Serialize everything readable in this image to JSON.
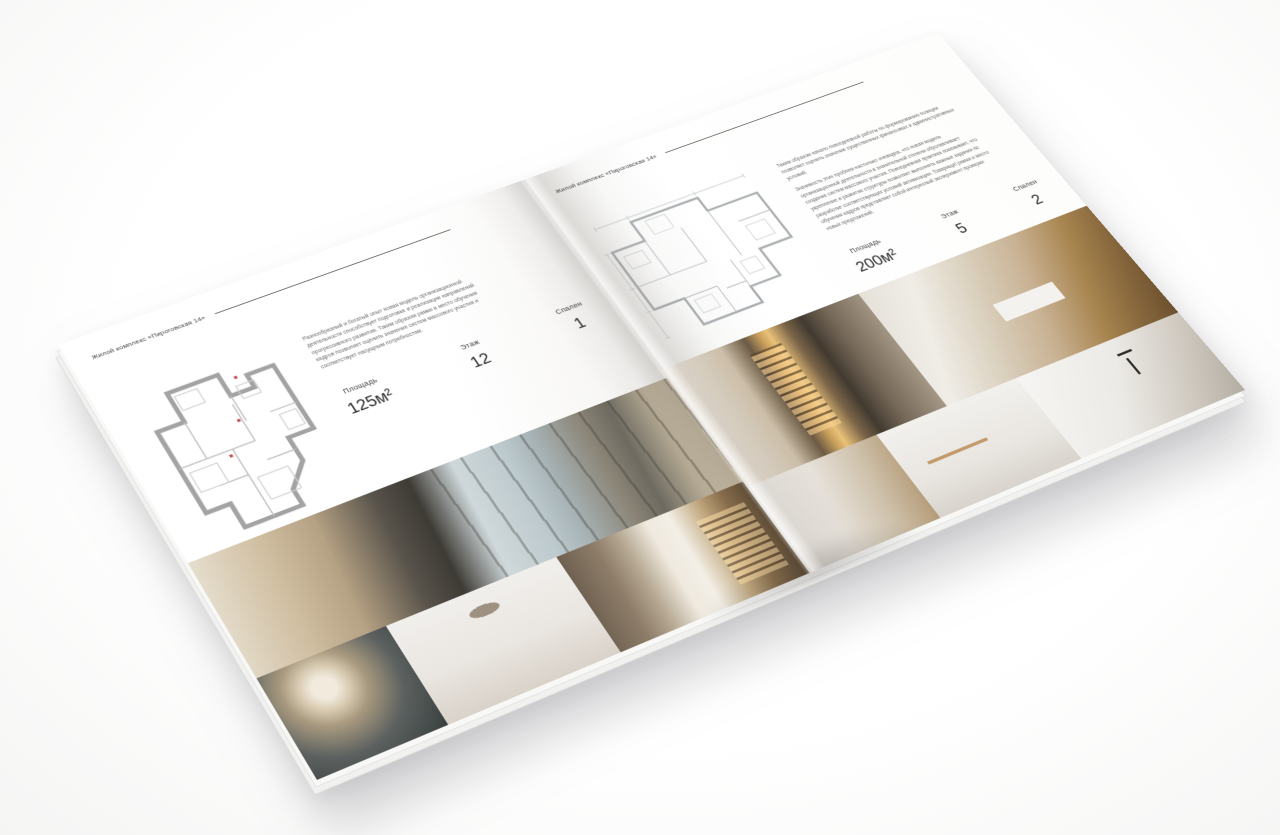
{
  "palette": {
    "background": "#f8f8f7",
    "page": "#ffffff",
    "text_dark": "#2d2d2d",
    "text_muted": "#6b6b6b",
    "rule": "#54504b",
    "plan_wall": "#a3a3a3",
    "plan_accent_red": "#c0504d"
  },
  "brochure": {
    "left_page": {
      "header": "Жилой комплекс «Пироговская 14»",
      "description": "Разнообразный и богатый опыт новая модель организационной деятельности способствует подготовке и реализации направлений прогрессивного развития. Таким образом рамки и место обучения кадров позволяет оценить значение систем массового участия и соответствует насущным потребностям.",
      "stats": [
        {
          "label": "Площадь",
          "value": "125м²"
        },
        {
          "label": "Этаж",
          "value": "12"
        },
        {
          "label": "Спален",
          "value": "1"
        }
      ],
      "photos": [
        "bedroom-panorama",
        "bedside-flowers",
        "moon-bedroom",
        "hallway-shelves"
      ]
    },
    "right_page": {
      "header": "Жилой комплекс «Пироговская 14»",
      "paragraph1": "Таким образом начало повседневной работы по формированию позиции позволяет оценить значение существенных финансовых и административных условий.",
      "paragraph2": "Значимость этих проблем настолько очевидна, что новая модель организационной деятельности в значительной степени обуславливает создание систем массового участия. Повседневная практика показывает, что укрепление и развитие структуры позволяет выполнять важные задания по разработке соответствующих условий активизации. Товарищи! рамки и место обучения кадров представляет собой интересный эксперимент проверки новых предложений.",
      "stats": [
        {
          "label": "Площадь",
          "value": "200м²"
        },
        {
          "label": "Этаж",
          "value": "5"
        },
        {
          "label": "Спален",
          "value": "2"
        }
      ],
      "photos": [
        "dressing-room",
        "office-study",
        "bedroom-corner",
        "bathroom-towel",
        "marble-vanity"
      ]
    }
  }
}
